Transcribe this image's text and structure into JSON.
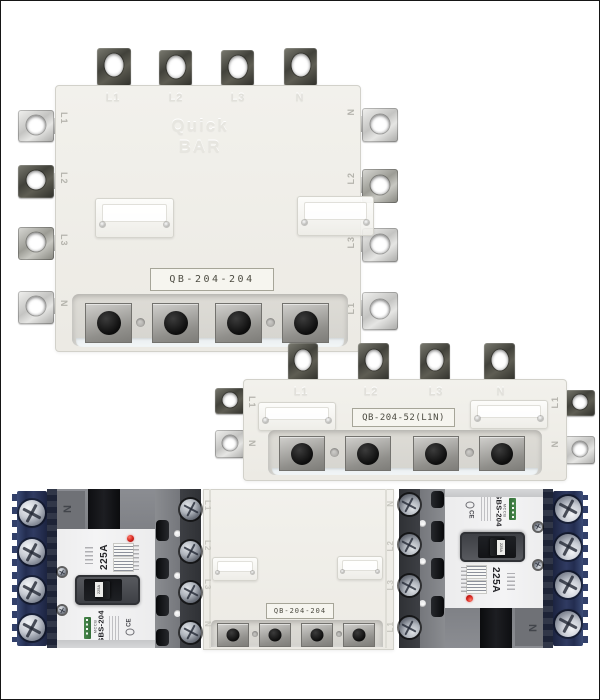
{
  "page": {
    "background": "#ffffff",
    "frame_color": "#161616"
  },
  "busbar_front": {
    "model": "QB-204-204",
    "brand_embossed": [
      "Quick",
      "BAR"
    ],
    "top_labels": [
      "L1",
      "L2",
      "L3",
      "N"
    ],
    "left_labels": [
      "L1",
      "L2",
      "L3",
      "N"
    ],
    "right_labels": [
      "N",
      "L2",
      "L3",
      "L1"
    ]
  },
  "busbar_side": {
    "model": "QB-204-52(L1N)",
    "top_labels": [
      "L1",
      "L2",
      "L3",
      "N"
    ],
    "left_tab_labels": [
      "L1",
      "N"
    ],
    "right_tab_labels": [
      "L1",
      "N"
    ]
  },
  "busbar_top_view": {
    "model": "QB-204-204",
    "left_labels": [
      "L1",
      "L2",
      "L3",
      "N"
    ],
    "right_labels": [
      "N",
      "L2",
      "L3",
      "L1"
    ]
  },
  "breaker": {
    "type": "MCCB",
    "model": "SBS-204",
    "rating": "225A",
    "pole_marking": "N",
    "toggle_label": "225A",
    "cert_mark": "CE"
  }
}
